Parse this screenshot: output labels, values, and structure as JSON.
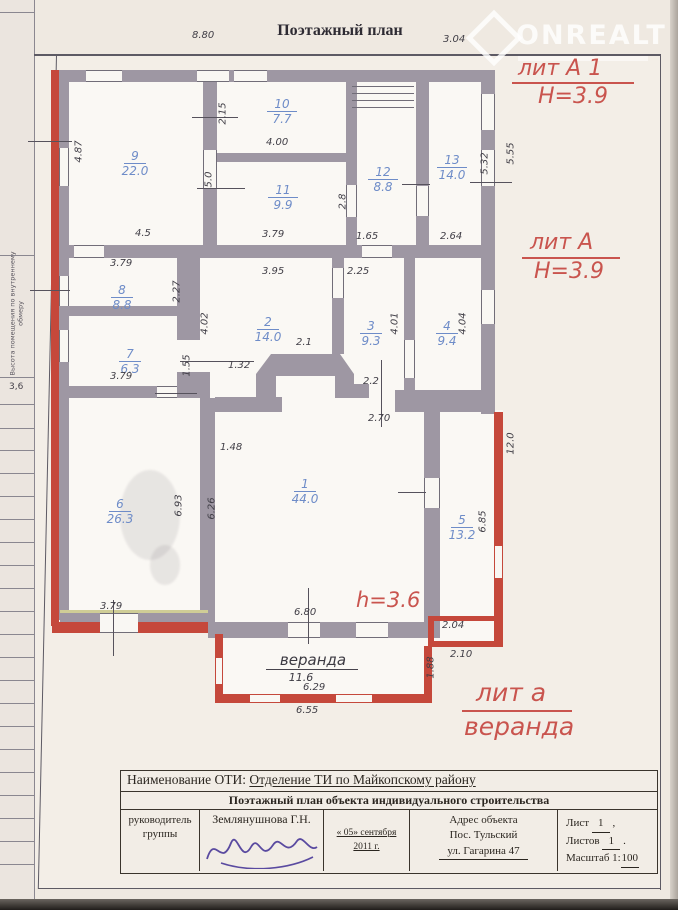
{
  "page": {
    "title": "Поэтажный план"
  },
  "watermark": {
    "brand": "ONREALT"
  },
  "sidebar": {
    "label": "Высота помещения по внутреннему обмеру",
    "value": "3,6"
  },
  "annotations": {
    "lit_a1": "лит А 1",
    "lit_a1_h": "Н=3.9",
    "lit_a": "лит А",
    "lit_a_h": "Н=3.9",
    "h_inner": "h=3.6",
    "lit_a_small": "лит а",
    "lit_a_small_name": "веранда"
  },
  "rooms": {
    "r1": {
      "n": "1",
      "a": "44.0"
    },
    "r2": {
      "n": "2",
      "a": "14.0"
    },
    "r3": {
      "n": "3",
      "a": "9.3"
    },
    "r4": {
      "n": "4",
      "a": "9.4"
    },
    "r5": {
      "n": "5",
      "a": "13.2"
    },
    "r6": {
      "n": "6",
      "a": "26.3"
    },
    "r7": {
      "n": "7",
      "a": "6.3"
    },
    "r8": {
      "n": "8",
      "a": "8.8"
    },
    "r9": {
      "n": "9",
      "a": "22.0"
    },
    "r10": {
      "n": "10",
      "a": "7.7"
    },
    "r11": {
      "n": "11",
      "a": "9.9"
    },
    "r12": {
      "n": "12",
      "a": "8.8"
    },
    "r13": {
      "n": "13",
      "a": "14.0"
    }
  },
  "veranda": {
    "name": "веранда",
    "area": "11.6"
  },
  "dims": [
    {
      "v": "8.80"
    },
    {
      "v": "3.04"
    },
    {
      "v": "4.87"
    },
    {
      "v": "4.5"
    },
    {
      "v": "2.15"
    },
    {
      "v": "4.00"
    },
    {
      "v": "5.0"
    },
    {
      "v": "3.79"
    },
    {
      "v": "2.8"
    },
    {
      "v": "5.32"
    },
    {
      "v": "5.55"
    },
    {
      "v": "1.65"
    },
    {
      "v": "2.64"
    },
    {
      "v": "3.79"
    },
    {
      "v": "2.27"
    },
    {
      "v": "3.95"
    },
    {
      "v": "2.25"
    },
    {
      "v": "4.02"
    },
    {
      "v": "4.01"
    },
    {
      "v": "4.04"
    },
    {
      "v": "3.79"
    },
    {
      "v": "1.55"
    },
    {
      "v": "1.32"
    },
    {
      "v": "2.1"
    },
    {
      "v": "2.2"
    },
    {
      "v": "2.70"
    },
    {
      "v": "1.48"
    },
    {
      "v": "6.93"
    },
    {
      "v": "6.26"
    },
    {
      "v": "6.80"
    },
    {
      "v": "3.79"
    },
    {
      "v": "6.85"
    },
    {
      "v": "12.0"
    },
    {
      "v": "2.04"
    },
    {
      "v": "2.10"
    },
    {
      "v": "1.88"
    },
    {
      "v": "6.29"
    },
    {
      "v": "6.55"
    }
  ],
  "footer": {
    "oti_label": "Наименование ОТИ:",
    "oti_value": "Отделение ТИ по Майкопскому району",
    "doc_title": "Поэтажный план объекта индивидуального  строительства",
    "role_line1": "руководитель",
    "role_line2": "группы",
    "name": "Землянушнова Г.Н.",
    "date_line1": "« 05» сентября",
    "date_line2": "2011 г.",
    "addr_label": "Адрес объекта",
    "addr_line1": "Пос. Тульский",
    "addr_line2": "ул. Гагарина 47",
    "sheet_label": "Лист",
    "sheet_value": "1",
    "sheets_label": "Листов",
    "sheets_value": "1",
    "scale_label": "Масштаб 1:",
    "scale_value": "100"
  }
}
